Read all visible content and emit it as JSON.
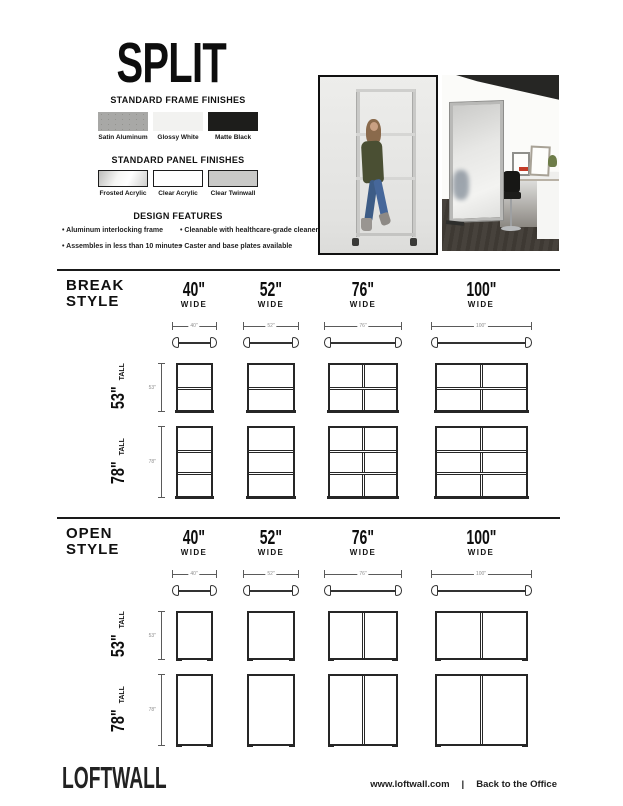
{
  "page": {
    "title": "SPLIT"
  },
  "finishes": {
    "frame": {
      "heading": "STANDARD FRAME FINISHES",
      "items": [
        {
          "label": "Satin Aluminum",
          "swatch": "satin",
          "color": "#a8a8a6"
        },
        {
          "label": "Glossy White",
          "swatch": "flat",
          "color": "#f2f2f0"
        },
        {
          "label": "Matte Black",
          "swatch": "flat",
          "color": "#1d1d1b"
        }
      ]
    },
    "panel": {
      "heading": "STANDARD PANEL FINISHES",
      "items": [
        {
          "label": "Frosted Acrylic",
          "swatch": "frosted",
          "color": "#e9e9e7"
        },
        {
          "label": "Clear Acrylic",
          "swatch": "flat-bordered",
          "color": "#ffffff"
        },
        {
          "label": "Clear Twinwall",
          "swatch": "flat-bordered",
          "color": "#c9c9c7"
        }
      ]
    }
  },
  "design_features": {
    "heading": "DESIGN FEATURES",
    "bullets_left": [
      "Aluminum interlocking frame",
      "Assembles in less than 10 minutes"
    ],
    "bullets_right": [
      "Cleanable with healthcare-grade cleaners",
      "Caster and base plates available"
    ]
  },
  "photos": {
    "left": {
      "description": "Person walking behind clear acrylic Split divider, studio"
    },
    "right": {
      "description": "Frosted acrylic Split divider beside office desk with stool"
    }
  },
  "sections": [
    {
      "name": "break",
      "title_line1": "BREAK",
      "title_line2": "STYLE",
      "columns": [
        {
          "label": "40\"",
          "sub": "WIDE",
          "dim": "40\"",
          "inches": 40,
          "panels_across": 1
        },
        {
          "label": "52\"",
          "sub": "WIDE",
          "dim": "52\"",
          "inches": 52,
          "panels_across": 1
        },
        {
          "label": "76\"",
          "sub": "WIDE",
          "dim": "76\"",
          "inches": 76,
          "panels_across": 2
        },
        {
          "label": "100\"",
          "sub": "WIDE",
          "dim": "100\"",
          "inches": 100,
          "panels_across": 2
        }
      ],
      "heights": [
        {
          "label": "53\"",
          "sub": "TALL",
          "dim": "53\"",
          "inches": 53,
          "panels_down": 2
        },
        {
          "label": "78\"",
          "sub": "TALL",
          "dim": "78\"",
          "inches": 78,
          "panels_down": 3
        }
      ]
    },
    {
      "name": "open",
      "title_line1": "OPEN",
      "title_line2": "STYLE",
      "columns": [
        {
          "label": "40\"",
          "sub": "WIDE",
          "dim": "40\"",
          "inches": 40,
          "panels_across": 1
        },
        {
          "label": "52\"",
          "sub": "WIDE",
          "dim": "52\"",
          "inches": 52,
          "panels_across": 1
        },
        {
          "label": "76\"",
          "sub": "WIDE",
          "dim": "76\"",
          "inches": 76,
          "panels_across": 2
        },
        {
          "label": "100\"",
          "sub": "WIDE",
          "dim": "100\"",
          "inches": 100,
          "panels_across": 2
        }
      ],
      "heights": [
        {
          "label": "53\"",
          "sub": "TALL",
          "dim": "53\"",
          "inches": 53,
          "panels_down": 1
        },
        {
          "label": "78\"",
          "sub": "TALL",
          "dim": "78\"",
          "inches": 78,
          "panels_down": 1
        }
      ]
    }
  ],
  "footer": {
    "logo": "LOFTWALL",
    "url": "www.loftwall.com",
    "separator": "|",
    "link": "Back to the Office"
  }
}
